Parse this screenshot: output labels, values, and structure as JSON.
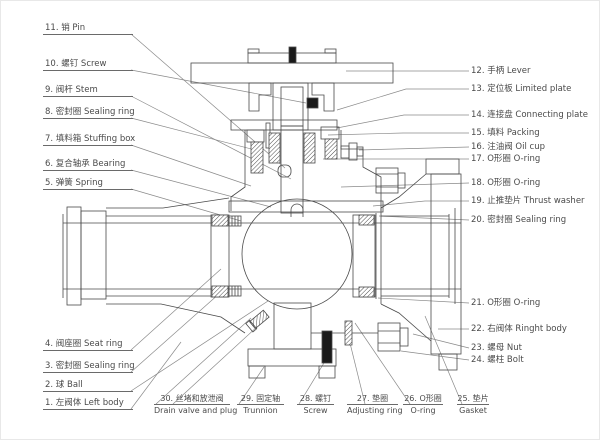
{
  "figure": {
    "type": "technical-cross-section",
    "subject": "trunnion mounted ball valve part diagram",
    "colors": {
      "line": "#4a4a4a",
      "leader": "#8a8a8a",
      "text": "#4a4a4a",
      "solid_part": "#1a1a1a"
    }
  },
  "labels": {
    "left": [
      {
        "text": "11. 销 Pin"
      },
      {
        "text": "10. 螺钉 Screw"
      },
      {
        "text": "9. 阀杆 Stem"
      },
      {
        "text": "8. 密封圈 Sealing ring"
      },
      {
        "text": "7. 填料箱 Stuffing box"
      },
      {
        "text": "6. 复合轴承 Bearing"
      },
      {
        "text": "5. 弹簧 Spring"
      },
      {
        "text": "4. 阀座圈 Seat ring"
      },
      {
        "text": "3. 密封圈 Sealing ring"
      },
      {
        "text": "2. 球 Ball"
      },
      {
        "text": "1. 左阀体 Left body"
      }
    ],
    "right": [
      {
        "text": "12. 手柄  Lever"
      },
      {
        "text": "13. 定位板 Limited plate"
      },
      {
        "text": "14. 连接盘 Connecting plate"
      },
      {
        "text": "15. 填料 Packing"
      },
      {
        "text": "16. 注油阀 Oil cup"
      },
      {
        "text": "17. O形圈 O-ring"
      },
      {
        "text": "18. O形圈 O-ring"
      },
      {
        "text": "19. 止推垫片 Thrust washer"
      },
      {
        "text": "20. 密封圈 Sealing ring"
      },
      {
        "text": "21. O形圈 O-ring"
      },
      {
        "text": "22. 右阀体 Ringht body"
      },
      {
        "text": "23. 螺母 Nut"
      },
      {
        "text": "24. 螺柱 Bolt"
      }
    ],
    "bottom": [
      {
        "line1": "30. 丝堵和放泄阀",
        "line2": "Drain valve and plug"
      },
      {
        "line1": "29. 固定轴",
        "line2": "Trunnion"
      },
      {
        "line1": "28. 螺钉",
        "line2": "Screw"
      },
      {
        "line1": "27. 垫圈",
        "line2": "Adjusting ring"
      },
      {
        "line1": "26. O形圈",
        "line2": "O-ring"
      },
      {
        "line1": "25. 垫片",
        "line2": "Gasket"
      }
    ]
  }
}
